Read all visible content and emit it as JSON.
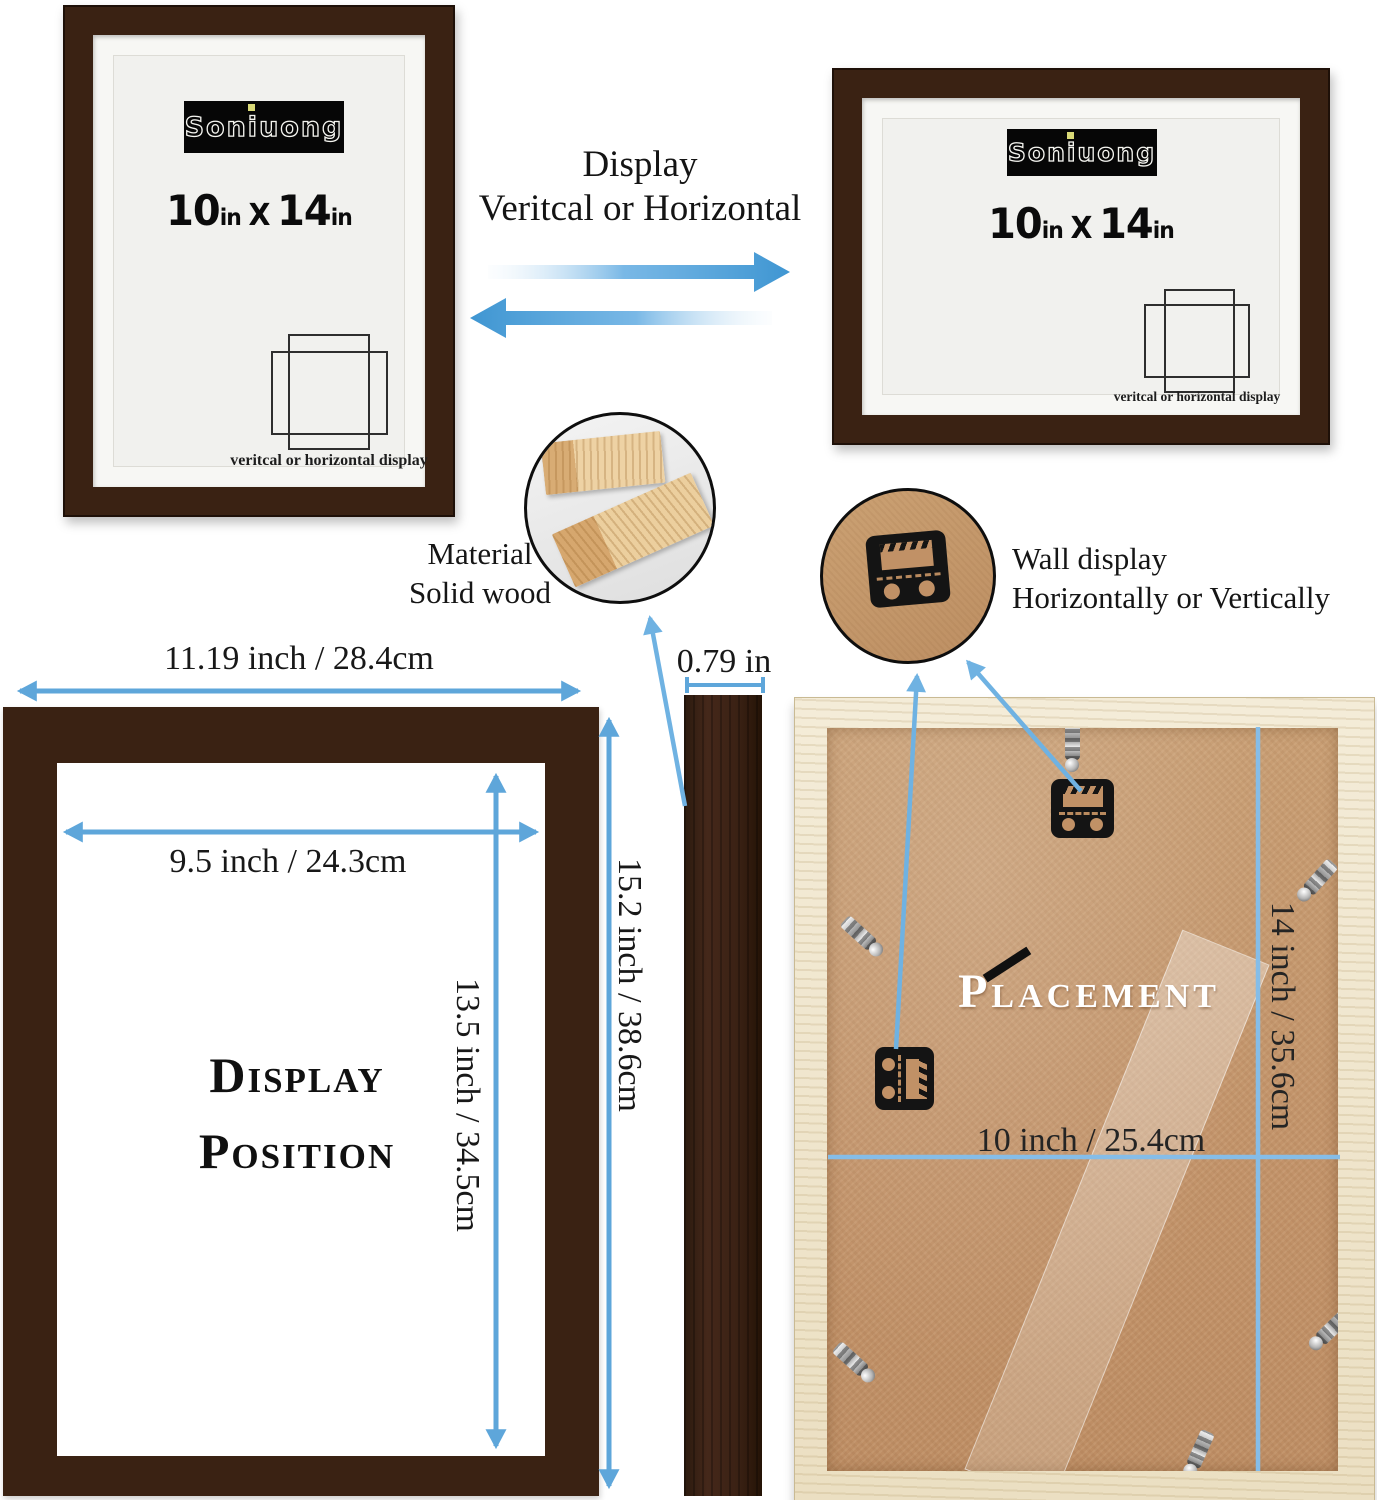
{
  "colors": {
    "frame_brown": "#3A2213",
    "accent_blue": "#5EA6DA",
    "light_blue_line": "#85BDE8",
    "wood_light": "#F0E6CD",
    "kraft_panel": "#C4986C",
    "logo_bg": "#060606",
    "logo_dot_yellow": "#D9D977"
  },
  "icons": {
    "orientation_icon": "two-overlapping-rectangles",
    "hanger_icon": "sawtooth-wall-hanger",
    "clip_icon": "metal-swing-clip",
    "direction_arrows_icon": "left-right-blue-gradient-arrows",
    "dimension_arrow_icon": "double-headed-blue-arrow"
  },
  "brand": {
    "logo_text": "Soniuong"
  },
  "frame_card": {
    "width_value": "10",
    "width_unit": "in",
    "separator": "X",
    "height_value": "14",
    "height_unit": "in",
    "caption": "veritcal or horizontal display"
  },
  "display_note": {
    "line1": "Display",
    "line2": "Veritcal or Horizontal"
  },
  "material_callout": {
    "line1": "Material",
    "line2": "Solid wood"
  },
  "wall_callout": {
    "line1": "Wall display",
    "line2": "Horizontally or Vertically"
  },
  "dimensions": {
    "outer_width": "11.19 inch / 28.4cm",
    "inner_width": "9.5 inch / 24.3cm",
    "inner_height": "13.5 inch / 34.5cm",
    "outer_height": "15.2 inch / 38.6cm",
    "depth": "0.79 in",
    "back_width": "10 inch / 25.4cm",
    "back_height": "14 inch / 35.6cm"
  },
  "left_diagram_title": {
    "line1": "Display",
    "line2": "Position"
  },
  "back_diagram_title": "Placement"
}
